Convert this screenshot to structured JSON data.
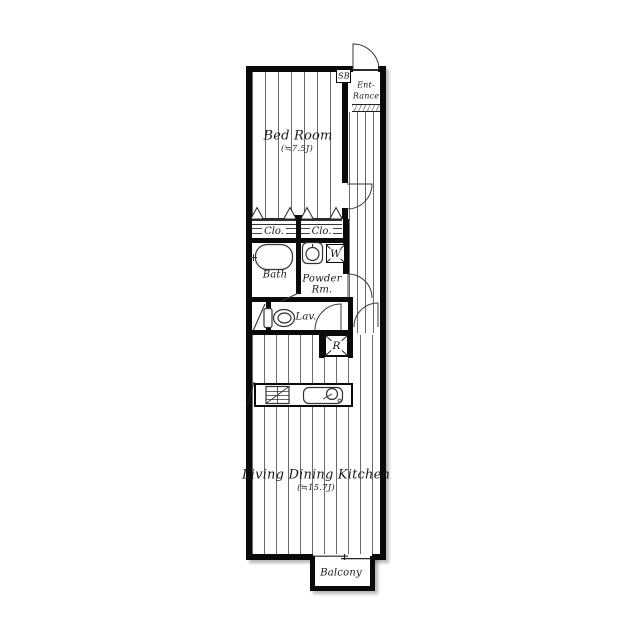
{
  "plan": {
    "bedroom": {
      "label": "Bed Room",
      "size": "(≒7.5J)"
    },
    "ldk": {
      "label": "Living Dining Kitchen",
      "size": "(≒15.7J)"
    },
    "entrance": {
      "line1": "Ent-",
      "line2": "Rance"
    },
    "shoe_box": {
      "label": "SB"
    },
    "closet_left": {
      "label": "Clo."
    },
    "closet_right": {
      "label": "Clo."
    },
    "bath": {
      "label": "Bath"
    },
    "powder_room": {
      "line1": "Powder",
      "line2": "Rm."
    },
    "washer": {
      "label": "W"
    },
    "lavatory": {
      "label": "Lav."
    },
    "refrigerator": {
      "label": "R"
    },
    "balcony": {
      "label": "Balcony"
    },
    "colors": {
      "wall": "#0a0a0a",
      "floor_line": "#6a6a6a",
      "fixture_line": "#333333",
      "background": "#ffffff"
    }
  }
}
